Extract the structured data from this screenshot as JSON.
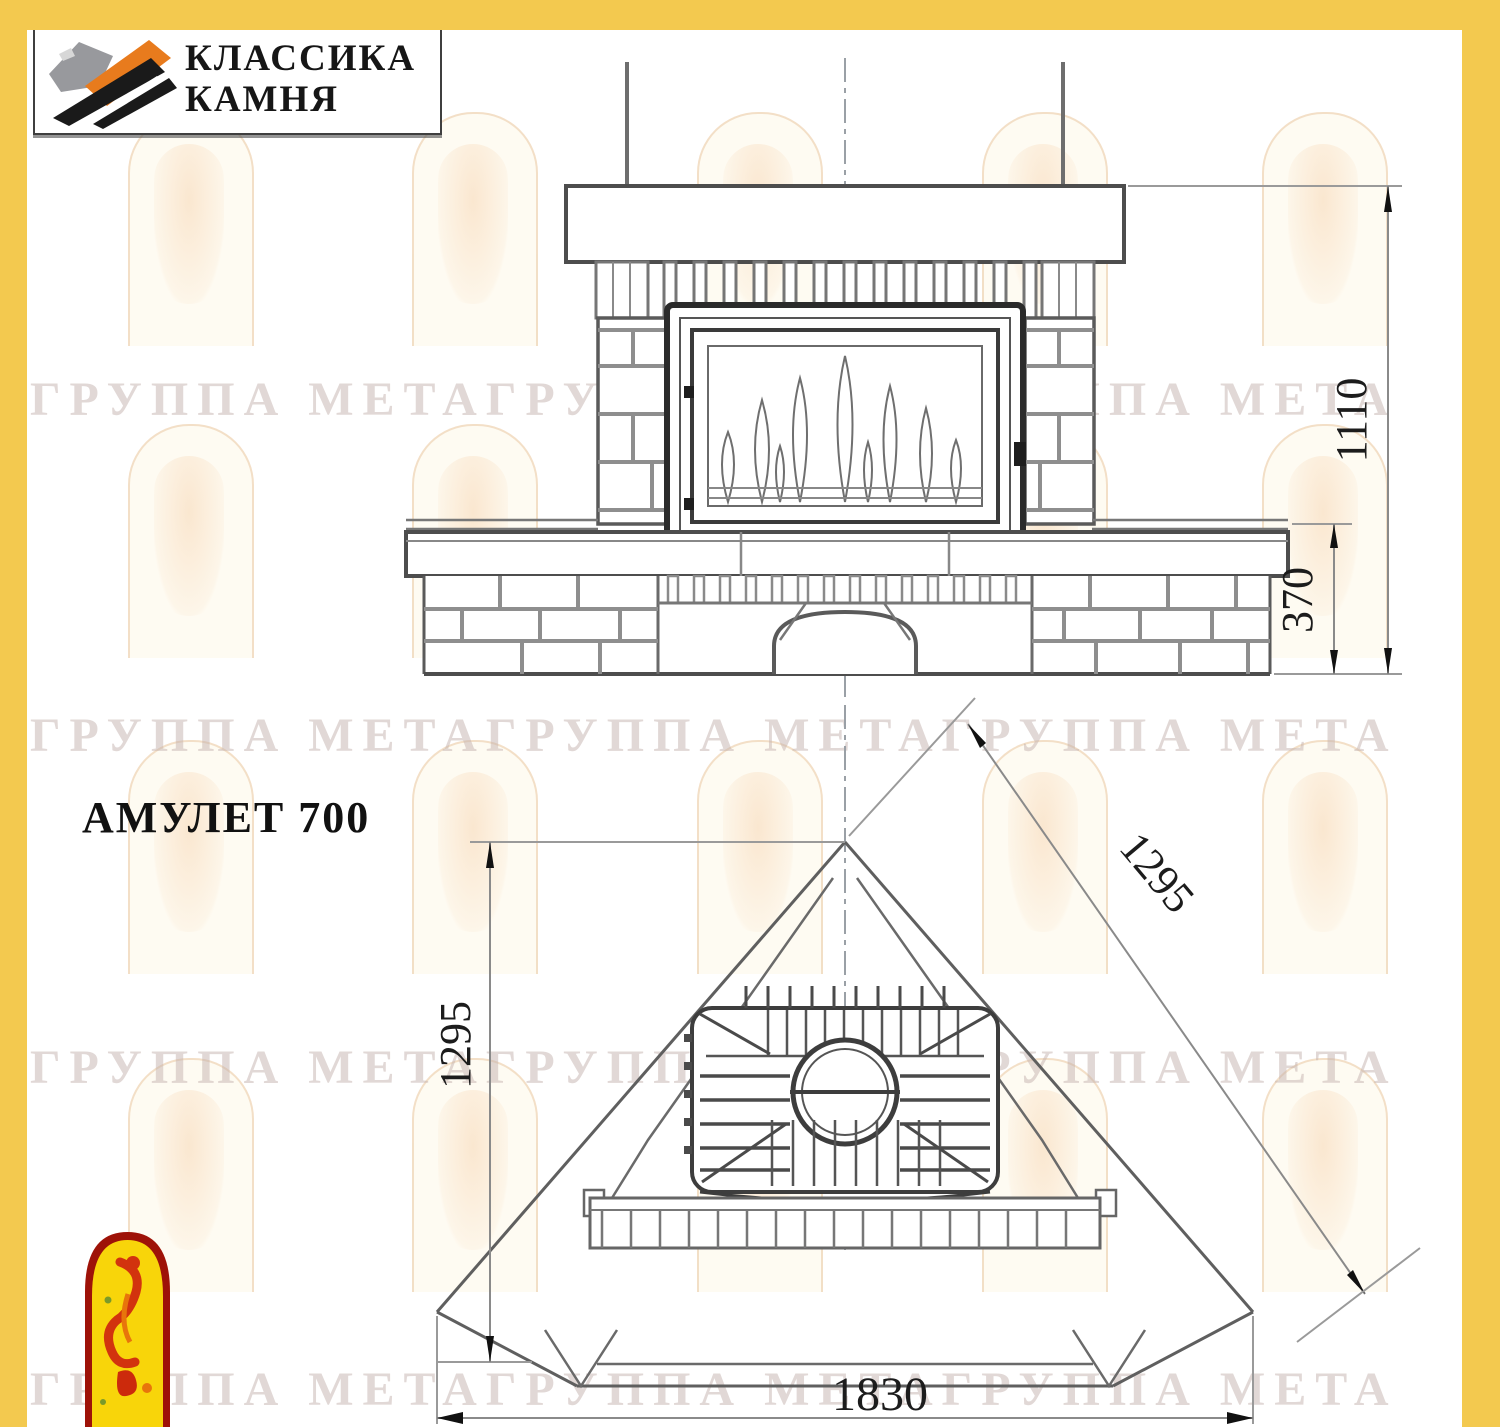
{
  "header": {
    "logo": {
      "line1": "КЛАССИКА",
      "line2": "КАМНЯ"
    }
  },
  "title": "АМУЛЕТ 700",
  "watermark_text": "ГРУППА МЕТАГРУППА МЕТАГРУППА МЕТА",
  "drawing": {
    "front_view": {
      "dim_total_height": "1110",
      "dim_bench_height": "370"
    },
    "plan_view": {
      "dim_depth_left": "1295",
      "dim_depth_right": "1295",
      "dim_width": "1830"
    }
  },
  "colors": {
    "frame_yellow": "#F3C94F",
    "logo_orange": "#E87B1D",
    "logo_gray": "#98999D",
    "logo_black": "#1A1A1A",
    "drawing_line": "#5A5A5A",
    "brick_joint": "#8E8E8E",
    "emblem_red": "#9E1208",
    "emblem_yellow": "#F8D50A",
    "emblem_flame": "#D2330E"
  }
}
